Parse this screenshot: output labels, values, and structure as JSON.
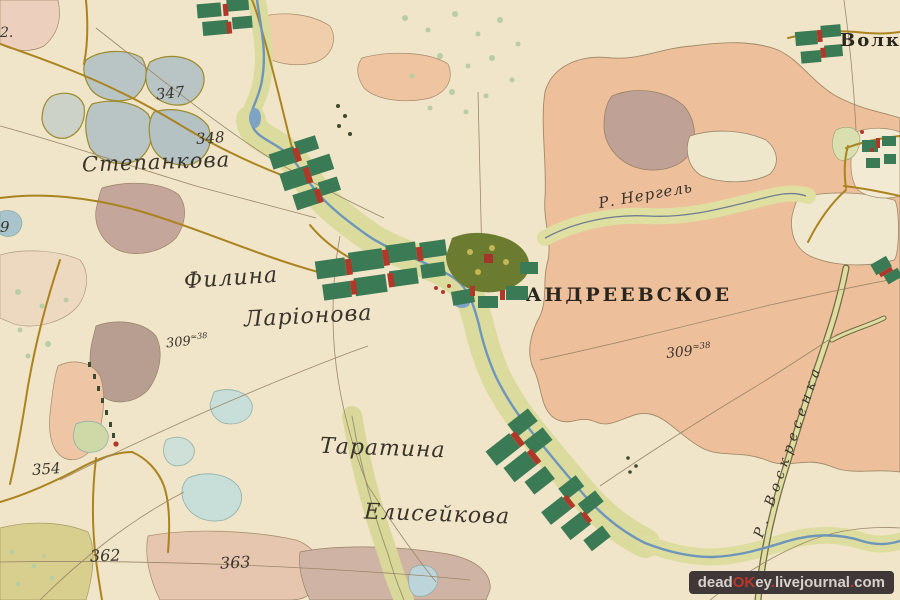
{
  "settlements": {
    "stepankova": "Степанкова",
    "filina": "Филина",
    "larionova": "Ларіонова",
    "andreevskoe": "АНДРЕЕВСКОЕ",
    "taratina": "Таратина",
    "eliseikova": "Елисейкова",
    "volkovo_partial": "Волко"
  },
  "rivers": {
    "nergel": "Р. Нергель",
    "voskresenka": "Р. Воскресенка"
  },
  "survey_numbers": {
    "n352_partial": "2.",
    "n347": "347",
    "n348": "348",
    "n9_partial": "9",
    "n354": "354",
    "n362": "362",
    "n363": "363",
    "area_left": {
      "main": "309",
      "sup": "≈38"
    },
    "area_right": {
      "main": "309",
      "sup": "≈38"
    }
  },
  "watermark": {
    "dead": "dead",
    "ok": "OK",
    "ey": "ey",
    "dot1": ".",
    "livejournal": "livejournal",
    "dot2": ".",
    "com": "com"
  },
  "colors": {
    "parchment": "#f0e5c9",
    "field_salmon": "#edbf9b",
    "valley_olive": "#dcdb9e",
    "lake_gray_blue": "#b9c5c4",
    "pond_aqua": "#c8ded8",
    "river_blue": "#6e96bb",
    "road_olive": "#ab831f",
    "village_green": "#3a7a55",
    "village_red": "#b03828",
    "ink": "#38332b"
  }
}
